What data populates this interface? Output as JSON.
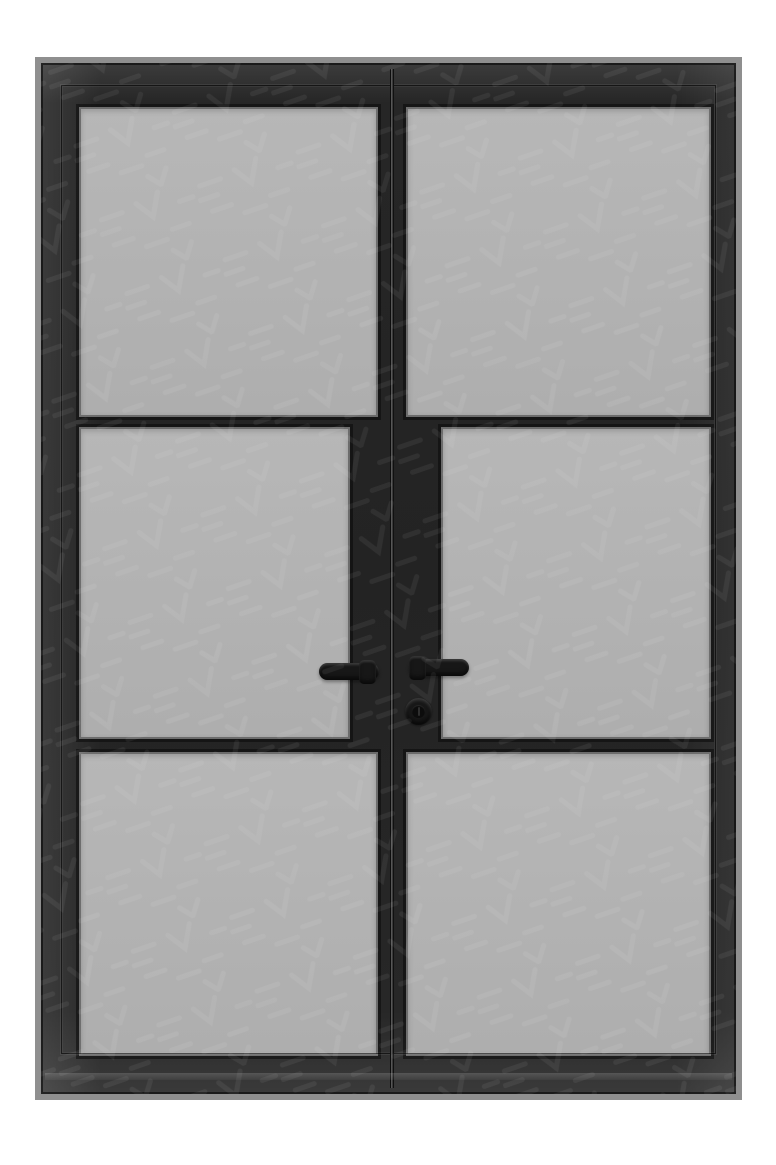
{
  "scene": {
    "type": "product-image",
    "subject": "black steel-framed double glass door, three glass lites per leaf",
    "leaves": 2,
    "panes_per_leaf": 3,
    "total_panes": 6,
    "hardware": {
      "left_door_handle": "lever handle pointing left",
      "right_door_handle": "lever handle pointing right",
      "lock": "round key cylinder below right handle"
    },
    "watermark": "faint repeating chevron/dash pattern over entire image"
  },
  "door": {
    "colors": {
      "background": "#ffffff",
      "frame": "#2b2b2b",
      "frame_highlight": "#454545",
      "frame_shadow": "#141414",
      "bevel": "#8f8f8f",
      "glass": "#b2b2b2",
      "glazing_bead": "#d7d7d7",
      "seam": "#565656",
      "hardware": "#171717",
      "watermark_stroke": "#ffffff"
    }
  }
}
